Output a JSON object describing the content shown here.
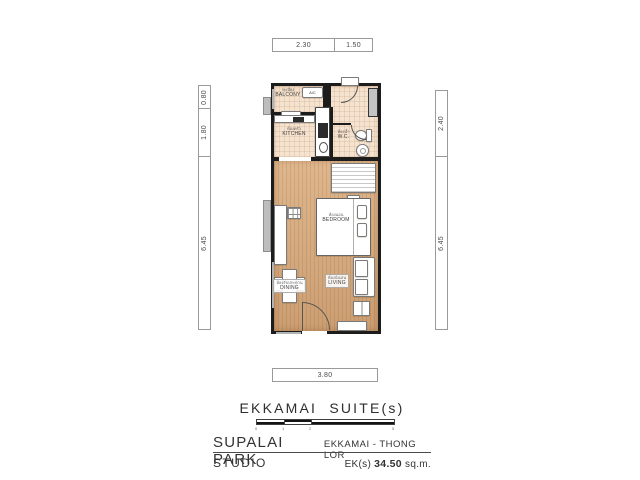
{
  "dimensions": {
    "top": [
      "2.30",
      "1.50"
    ],
    "left": [
      "0.80",
      "1.80",
      "6.45"
    ],
    "right": [
      "2.40",
      "6.45"
    ],
    "bottom": [
      "3.80"
    ]
  },
  "rooms": {
    "balcony": {
      "th": "ระเบียง",
      "en": "BALCONY"
    },
    "kitchen": {
      "th": "ห้องครัว",
      "en": "KITCHEN"
    },
    "wc": {
      "th": "ห้องน้ำ",
      "en": "W.C."
    },
    "bedroom": {
      "th": "ห้องนอน",
      "en": "BEDROOM"
    },
    "dining": {
      "th": "ห้องรับประทาน",
      "en": "DINING"
    },
    "living": {
      "th": "ห้องนั่งเล่น",
      "en": "LIVING"
    },
    "ac_unit": "A/C"
  },
  "title_block": {
    "plan_title": "EKKAMAI  SUITE(s)",
    "project_name": "SUPALAI PARK",
    "location": "EKKAMAI - THONG LOR",
    "unit_type": "STUDIO",
    "area_prefix": "EK(s)",
    "area_value": "34.50",
    "area_unit": "sq.m.",
    "scale_ticks": [
      "0",
      "1",
      "2",
      "5"
    ]
  },
  "colors": {
    "wall": "#1c1c1c",
    "wood_floor": "#dbad7e",
    "tile_floor": "#f6e3cf",
    "fixture_gray": "#c4c4c4"
  }
}
